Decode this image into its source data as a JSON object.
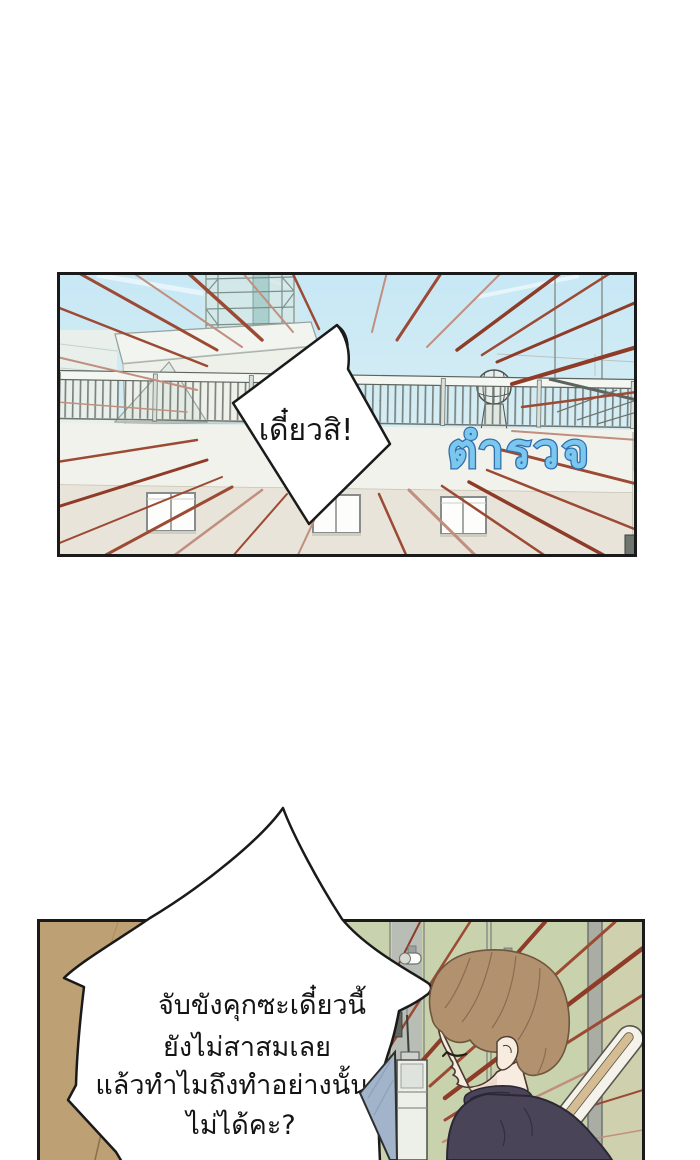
{
  "page": {
    "type": "webtoon-comic-page",
    "background": "#ffffff"
  },
  "palette": {
    "ink": "#1a1a1a",
    "bubble_fill": "#ffffff",
    "speedline_red": "#9c4a33",
    "speedline_red_light": "#c08f7e",
    "speedline_red_dark": "#8e3b28",
    "sky": "#cdeaf4",
    "building_white": "#f1f2ec",
    "wall_beige": "#e8e4d9",
    "sign_fill": "#7cc7ee",
    "sign_stroke": "#2f6fae",
    "locker_green": "#c8d2ac",
    "locker_olive": "#cfd0ae",
    "pillar_gray": "#a9ada4",
    "wood_brown": "#bda073",
    "hair_brown": "#b2916f",
    "skin": "#f8ece1",
    "sweater_purple": "#4a4458",
    "board_blue": "#a2b4ca",
    "chair_cream": "#f5f2e9",
    "chair_tan": "#d6bc92"
  },
  "panels": {
    "top": {
      "scene": "police-station-rooftop-with-speedlines",
      "bubble": {
        "text": "เดี๋ยวสิ!"
      },
      "sign": {
        "text": "ตำรวจ"
      }
    },
    "bottom": {
      "scene": "locker-room-character-profile",
      "bubble": {
        "lines": [
          "จับขังคุกซะเดี๋ยวนี้",
          "ยังไม่สาสมเลย",
          "แล้วทำไมถึงทำอย่างนั้น",
          "ไม่ได้คะ?"
        ]
      }
    }
  }
}
